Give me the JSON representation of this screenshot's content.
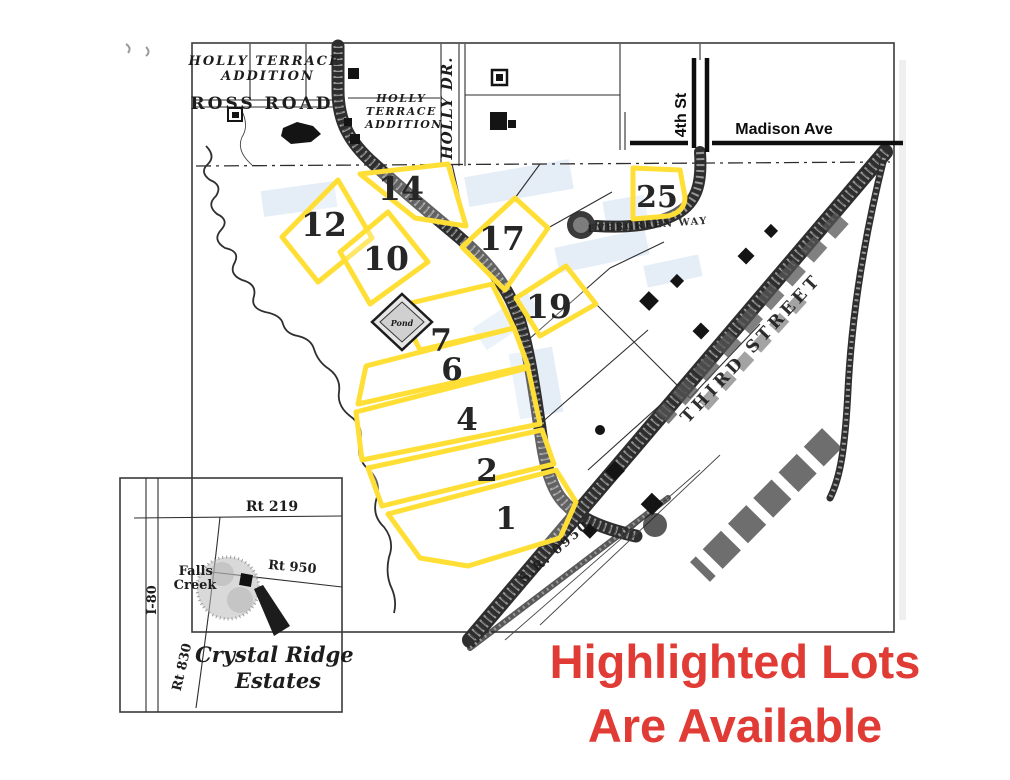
{
  "main_map": {
    "labels": {
      "holly_terrace_1_line1": "HOLLY TERRACE",
      "holly_terrace_1_line2": "ADDITION",
      "ross_road": "ROSS ROAD",
      "holly_terrace_2_line1": "HOLLY",
      "holly_terrace_2_line2": "TERRACE",
      "holly_terrace_2_line3": "ADDITION",
      "holly_dr": "HOLLY DR.",
      "fourth_st": "4th St",
      "madison_ave": "Madison Ave",
      "evergreen_way": "EVERGREEN WAY",
      "third_street": "THIRD STREET",
      "sr_0950": "S.R. 0950",
      "pond": "Pond"
    },
    "lots": [
      {
        "number": "14"
      },
      {
        "number": "12"
      },
      {
        "number": "10"
      },
      {
        "number": "17"
      },
      {
        "number": "25"
      },
      {
        "number": "19"
      },
      {
        "number": "7"
      },
      {
        "number": "6"
      },
      {
        "number": "4"
      },
      {
        "number": "2"
      },
      {
        "number": "1"
      }
    ],
    "highlight_color": "#FFDF35"
  },
  "inset_map": {
    "labels": {
      "rt_219": "Rt 219",
      "rt_950": "Rt 950",
      "rt_830": "Rt 830",
      "i_80": "I-80",
      "falls_creek_line1": "Falls",
      "falls_creek_line2": "Creek",
      "estates_line1": "Crystal Ridge",
      "estates_line2": "Estates"
    }
  },
  "annotation": {
    "line1": "Highlighted Lots",
    "line2": "Are Available",
    "color": "#E03B35"
  }
}
